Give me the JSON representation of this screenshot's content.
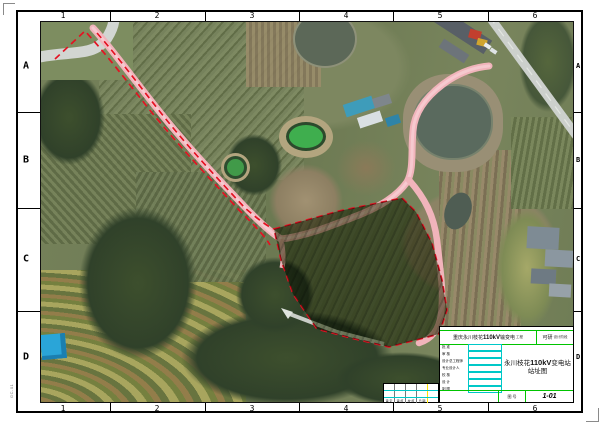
{
  "sheet": {
    "grid_columns": [
      "1",
      "2",
      "3",
      "4",
      "5",
      "6"
    ],
    "grid_rows": [
      "A",
      "B",
      "C",
      "D"
    ],
    "plot_stamp": "GC-01"
  },
  "title_block": {
    "project": {
      "prefix": "重庆永川枝花",
      "bold": "110kV",
      "suffix": "输变电",
      "small": "工程"
    },
    "stage": {
      "label": "可研",
      "note": "设计阶段"
    },
    "approval_rows": [
      {
        "label": "批 准"
      },
      {
        "label": "审 核"
      },
      {
        "label": "设计总工程师"
      },
      {
        "label": "专业设计人"
      },
      {
        "label": "校 核"
      },
      {
        "label": "设 计"
      },
      {
        "label": "制 图"
      }
    ],
    "main_title": {
      "prefix": "永川枝花",
      "bold": "110kV",
      "suffix": "变电站站址图"
    },
    "drawing_no": {
      "label": "图 号",
      "value": "1-01"
    },
    "signature_row": [
      "审 定",
      "审 核",
      "校 核",
      "日 期"
    ]
  },
  "map": {
    "colors": {
      "site_boundary_red": "#e41222",
      "access_road_pink": "#f1b4bb",
      "table_line_green": "#00c400",
      "table_cell_cyan": "#00c8c8",
      "table_line_yellow": "#ffe400"
    }
  }
}
